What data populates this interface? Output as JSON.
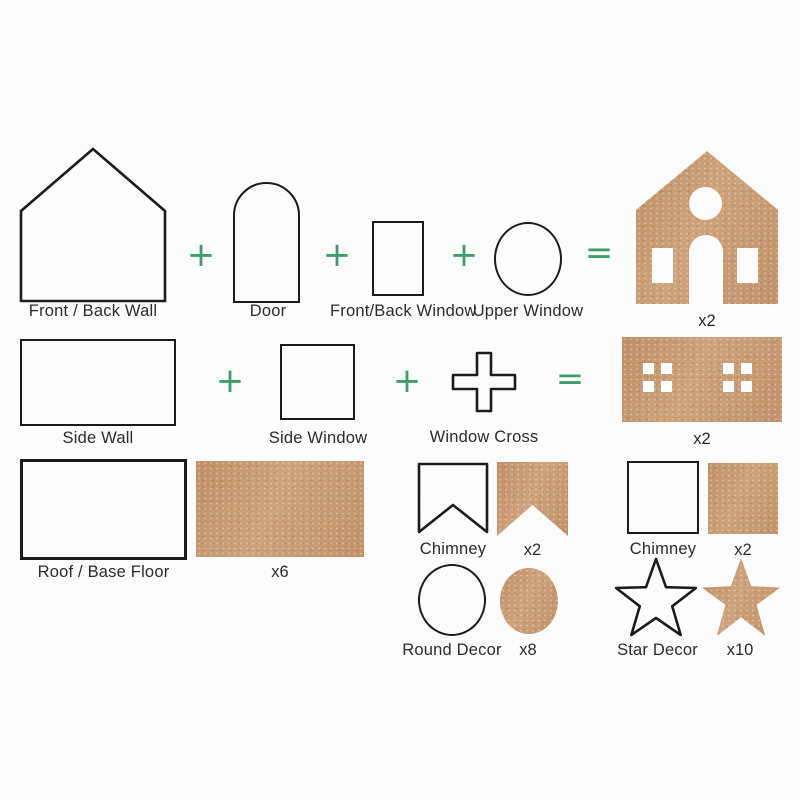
{
  "title": "DIY house kit assembly diagram",
  "colors": {
    "accent_green": "#3f9e68",
    "kraft_brown": "#c69871",
    "outline_black": "#1b1b1b",
    "background": "#fcfcfc",
    "text": "#2b2b2b"
  },
  "operators": {
    "plus": "+",
    "equals": "="
  },
  "row1": {
    "front_back_wall": {
      "label": "Front / Back Wall"
    },
    "door": {
      "label": "Door"
    },
    "front_back_window": {
      "label": "Front/Back Window"
    },
    "upper_window": {
      "label": "Upper Window"
    },
    "result": {
      "count": "x2"
    }
  },
  "row2": {
    "side_wall": {
      "label": "Side Wall"
    },
    "side_window": {
      "label": "Side Window"
    },
    "window_cross": {
      "label": "Window Cross"
    },
    "result": {
      "count": "x2"
    }
  },
  "row3": {
    "roof_base_floor": {
      "label": "Roof / Base Floor",
      "count": "x6"
    },
    "chimney_front": {
      "label": "Chimney",
      "count": "x2"
    },
    "chimney_side": {
      "label": "Chimney",
      "count": "x2"
    }
  },
  "row4": {
    "round_decor": {
      "label": "Round Decor",
      "count": "x8"
    },
    "star_decor": {
      "label": "Star Decor",
      "count": "x10"
    }
  }
}
